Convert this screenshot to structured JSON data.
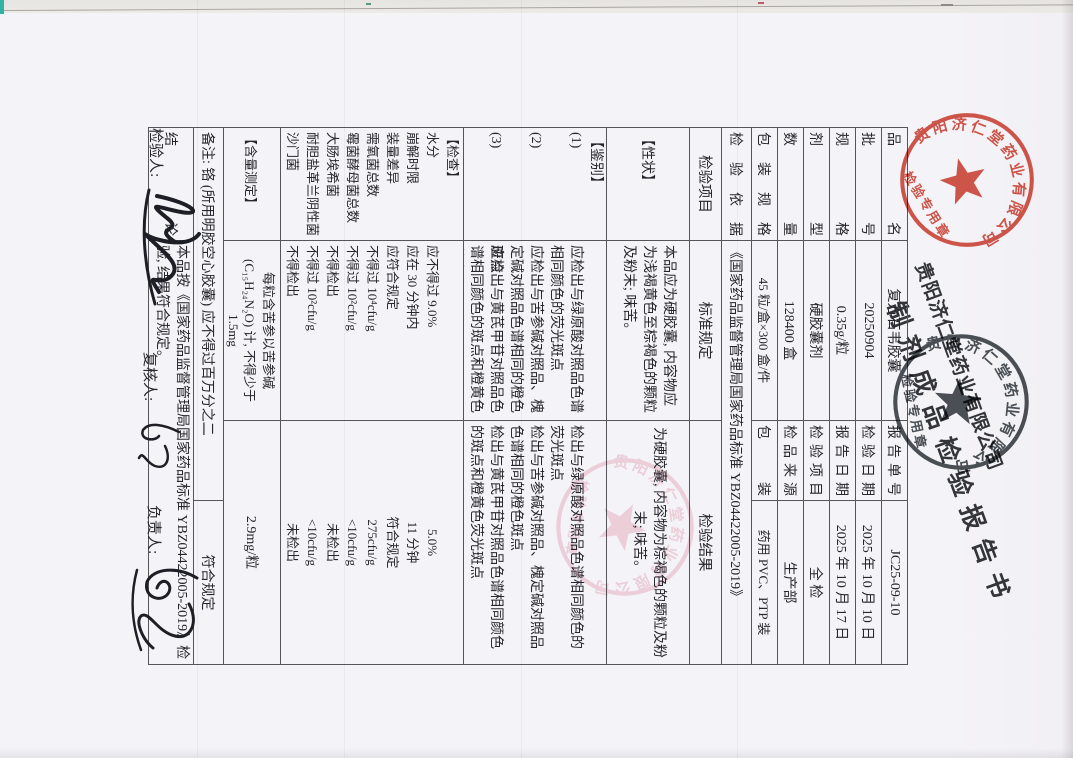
{
  "header": {
    "company": "贵阳济仁堂药业有限公司",
    "title": "制剂成品检验报告书"
  },
  "seals": {
    "ring_text": "贵阳济仁堂药业有限公司",
    "caption": "检验专用章"
  },
  "info": {
    "rows": [
      {
        "l1": "品名",
        "v1": "复方石韦胶囊",
        "l2": "报告单号",
        "v2": "JC25-09-10"
      },
      {
        "l1": "批号",
        "v1": "20250904",
        "l2": "检验日期",
        "v2": "2025 年 10 月 10 日"
      },
      {
        "l1": "规格",
        "v1": "0.35g/粒",
        "l2": "报告日期",
        "v2": "2025 年 10 月 17 日"
      },
      {
        "l1": "剂型",
        "v1": "硬胶囊剂",
        "l2": "检验项目",
        "v2": "全  检"
      },
      {
        "l1": "数量",
        "v1": "128400 盒",
        "l2": "检品来源",
        "v2": "生产部"
      },
      {
        "l1": "包装规格",
        "v1": "45 粒/盒×300 盒/件",
        "l2": "包装",
        "v2": "药用 PVC、PTP 装"
      }
    ],
    "basis_label": "检验依据",
    "basis_value": "《国家药品监督管理局国家药品标准 YBZ04422005-2019》"
  },
  "results": {
    "headers": {
      "item": "检验项目",
      "standard": "标准规定",
      "result": "检验结果"
    },
    "xingzhuang": {
      "label": "【性状】",
      "standard": "本品应为硬胶囊, 内容物应为浅褐黄色至棕褐色的颗粒及粉末; 味苦。",
      "result": "为硬胶囊, 内容物为棕褐色的颗粒及粉末; 味苦。"
    },
    "jianbie": {
      "label": "【鉴别】",
      "items": [
        {
          "num": "(1)",
          "standard": "应检出与绿原酸对照品色谱相同颜色的荧光斑点",
          "result": "检出与绿原酸对照品色谱相同颜色的荧光斑点"
        },
        {
          "num": "(2)",
          "standard": "应检出与苦参碱对照品、槐定碱对照品色谱相同的橙色斑点",
          "result": "检出与苦参碱对照品、槐定碱对照品色谱相同的橙色斑点"
        },
        {
          "num": "(3)",
          "standard": "应检出与黄芪甲苷对照品色谱相同颜色的斑点和橙黄色荧光斑点",
          "result": "检出与黄芪甲苷对照品色谱相同颜色的斑点和橙黄色荧光斑点"
        }
      ]
    },
    "jiancha": {
      "label": "【检查】",
      "items": [
        {
          "name": "水分",
          "standard": "应不得过 9.0%",
          "result": "5.0%"
        },
        {
          "name": "崩解时限",
          "standard": "应在 30 分钟内",
          "result": "11 分钟"
        },
        {
          "name": "装量差异",
          "standard": "应符合规定",
          "result": "符合规定"
        },
        {
          "name": "需氧菌总数",
          "standard": "不得过 10⁴cfu/g",
          "result": "275cfu/g"
        },
        {
          "name": "霉菌酵母菌总数",
          "standard": "不得过 10²cfu/g",
          "result": "<10cfu/g"
        },
        {
          "name": "大肠埃希菌",
          "standard": "不得检出",
          "result": "未检出"
        },
        {
          "name": "耐胆盐革兰阴性菌",
          "standard": "不得过 10²cfu/g",
          "result": "<10cfu/g"
        },
        {
          "name": "沙门菌",
          "standard": "不得检出",
          "result": "未检出"
        }
      ]
    },
    "hanliang": {
      "label": "【含量测定】",
      "standard": "每粒含苦参以苦参碱\n(C₁₅H₂₄N₂O) 计, 不得少于 1.5mg",
      "result": "2.9mg/粒"
    },
    "remark": {
      "text": "备注: 铬 (所用明胶空心胶囊) 应不得过百万分之二",
      "result": "符合规定"
    },
    "conclusion": {
      "label": "结论",
      "text": "本品按《国家药品监督管理局国家药品标准 YBZ04422005-2019》检验, 结果符合规定。"
    }
  },
  "signatures": {
    "inspector_label": "检验人:",
    "reviewer_label": "复核人:",
    "approver_label": "负责人:"
  },
  "colors": {
    "seal_red": "#cf3a2b",
    "seal_dark": "#343a41",
    "seal_pink": "#d95f78",
    "ink": "#26272e",
    "grid": "#55555a",
    "page_bg": "#f4f3f7"
  }
}
